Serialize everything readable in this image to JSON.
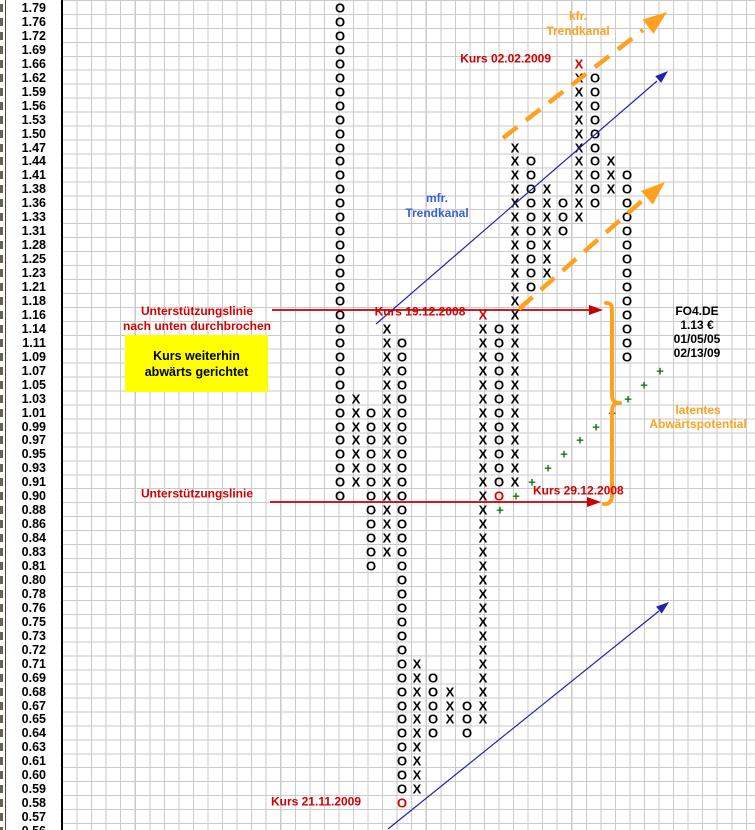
{
  "colors": {
    "red_text": "#D40000",
    "red_line": "#C80000",
    "orange": "#FFA11E",
    "blue_text": "#3761D6",
    "blue_line": "#2222AC",
    "green": "#157815",
    "yellow": "#FFFF00",
    "grid": "#CACACA",
    "symbol": "#000000"
  },
  "annotations": {
    "kfr_trendkanal": {
      "line1": "kfr.",
      "line2": "Trendkanal"
    },
    "mfr_trendkanal": {
      "line1": "mfr.",
      "line2": "Trendkanal"
    },
    "kurs_02_02_2009": "Kurs 02.02.2009",
    "kurs_19_12_2008": "Kurs 19.12.2008",
    "kurs_29_12_2008": "Kurs 29.12.2008",
    "kurs_21_11_2009": "Kurs 21.11.2009",
    "support_broken": {
      "line1": "Unterstützungslinie",
      "line2": "nach unten durchbrochen"
    },
    "support": "Unterstützungslinie",
    "note_box": {
      "line1": "Kurs weiterhin",
      "line2": "abwärts gerichtet"
    },
    "latent": {
      "line1": "latentes",
      "line2": "Abwärtspotential"
    }
  },
  "chart_data": {
    "type": "point-and-figure",
    "instrument": {
      "symbol": "FO4.DE",
      "last_price": "1.13 €",
      "start_date": "01/05/05",
      "end_date": "02/13/09"
    },
    "y_axis_prices": [
      "1.79",
      "1.76",
      "1.72",
      "1.69",
      "1.66",
      "1.62",
      "1.59",
      "1.56",
      "1.53",
      "1.50",
      "1.47",
      "1.44",
      "1.41",
      "1.38",
      "1.36",
      "1.33",
      "1.31",
      "1.28",
      "1.25",
      "1.23",
      "1.21",
      "1.18",
      "1.16",
      "1.14",
      "1.11",
      "1.09",
      "1.07",
      "1.05",
      "1.03",
      "1.01",
      "0.99",
      "0.97",
      "0.95",
      "0.93",
      "0.91",
      "0.90",
      "0.88",
      "0.86",
      "0.84",
      "0.83",
      "0.81",
      "0.80",
      "0.78",
      "0.76",
      "0.75",
      "0.73",
      "0.72",
      "0.71",
      "0.69",
      "0.68",
      "0.67",
      "0.65",
      "0.64",
      "0.63",
      "0.61",
      "0.60",
      "0.59",
      "0.58",
      "0.57",
      "0.56"
    ],
    "grid_on": true,
    "columns": [
      {
        "symbol": "O",
        "x": 340,
        "top_price": "1.79",
        "bottom_price": "0.90",
        "top_row": 0,
        "bottom_row": 35,
        "red_rows": []
      },
      {
        "symbol": "X",
        "x": 356,
        "top_price": "1.03",
        "bottom_price": "0.91",
        "top_row": 28,
        "bottom_row": 34,
        "red_rows": []
      },
      {
        "symbol": "O",
        "x": 371,
        "top_price": "1.01",
        "bottom_price": "0.81",
        "top_row": 29,
        "bottom_row": 40,
        "red_rows": []
      },
      {
        "symbol": "X",
        "x": 387,
        "top_price": "1.14",
        "bottom_price": "0.83",
        "top_row": 23,
        "bottom_row": 39,
        "red_rows": []
      },
      {
        "symbol": "O",
        "x": 402,
        "top_price": "1.11",
        "bottom_price": "0.58",
        "top_row": 24,
        "bottom_row": 57,
        "red_rows": [
          57
        ]
      },
      {
        "symbol": "X",
        "x": 417,
        "top_price": "0.71",
        "bottom_price": "0.59",
        "top_row": 47,
        "bottom_row": 56,
        "red_rows": []
      },
      {
        "symbol": "O",
        "x": 433,
        "top_price": "0.69",
        "bottom_price": "0.64",
        "top_row": 48,
        "bottom_row": 52,
        "red_rows": []
      },
      {
        "symbol": "X",
        "x": 450,
        "top_price": "0.68",
        "bottom_price": "0.65",
        "top_row": 49,
        "bottom_row": 51,
        "red_rows": []
      },
      {
        "symbol": "O",
        "x": 467,
        "top_price": "0.67",
        "bottom_price": "0.64",
        "top_row": 50,
        "bottom_row": 52,
        "red_rows": []
      },
      {
        "symbol": "X",
        "x": 483,
        "top_price": "1.16",
        "bottom_price": "0.65",
        "top_row": 22,
        "bottom_row": 51,
        "red_rows": [
          22
        ]
      },
      {
        "symbol": "O",
        "x": 499,
        "top_price": "1.14",
        "bottom_price": "0.90",
        "top_row": 23,
        "bottom_row": 35,
        "red_rows": [
          35
        ]
      },
      {
        "symbol": "X",
        "x": 515,
        "top_price": "1.47",
        "bottom_price": "0.91",
        "top_row": 10,
        "bottom_row": 34,
        "red_rows": []
      },
      {
        "symbol": "O",
        "x": 531,
        "top_price": "1.44",
        "bottom_price": "1.21",
        "top_row": 11,
        "bottom_row": 20,
        "red_rows": []
      },
      {
        "symbol": "X",
        "x": 547,
        "top_price": "1.38",
        "bottom_price": "1.23",
        "top_row": 13,
        "bottom_row": 19,
        "red_rows": []
      },
      {
        "symbol": "O",
        "x": 563,
        "top_price": "1.36",
        "bottom_price": "1.31",
        "top_row": 14,
        "bottom_row": 16,
        "red_rows": []
      },
      {
        "symbol": "X",
        "x": 579,
        "top_price": "1.66",
        "bottom_price": "1.33",
        "top_row": 4,
        "bottom_row": 15,
        "red_rows": [
          4
        ]
      },
      {
        "symbol": "O",
        "x": 595,
        "top_price": "1.62",
        "bottom_price": "1.36",
        "top_row": 5,
        "bottom_row": 14,
        "red_rows": []
      },
      {
        "symbol": "X",
        "x": 611,
        "top_price": "1.44",
        "bottom_price": "1.38",
        "top_row": 11,
        "bottom_row": 13,
        "red_rows": []
      },
      {
        "symbol": "O",
        "x": 627,
        "top_price": "1.41",
        "bottom_price": "1.09",
        "top_row": 12,
        "bottom_row": 25,
        "red_rows": []
      }
    ],
    "plus_markers": [
      {
        "x": 500,
        "row": 36,
        "price": "0.88"
      },
      {
        "x": 516,
        "row": 35,
        "price": "0.90"
      },
      {
        "x": 532,
        "row": 34,
        "price": "0.91"
      },
      {
        "x": 548,
        "row": 33,
        "price": "0.93"
      },
      {
        "x": 564,
        "row": 32,
        "price": "0.95"
      },
      {
        "x": 580,
        "row": 31,
        "price": "0.97"
      },
      {
        "x": 596,
        "row": 30,
        "price": "0.99"
      },
      {
        "x": 612,
        "row": 29,
        "price": "1.01"
      },
      {
        "x": 628,
        "row": 28,
        "price": "1.03"
      },
      {
        "x": 644,
        "row": 27,
        "price": "1.05"
      },
      {
        "x": 660,
        "row": 26,
        "price": "1.07"
      }
    ],
    "support_lines": [
      {
        "price": "1.16",
        "y": 310,
        "x1": 272,
        "x2": 590,
        "tip_x": 603
      },
      {
        "price": "0.90",
        "y": 502,
        "x1": 270,
        "x2": 588,
        "tip_x": 601
      }
    ],
    "blue_trend_lines": [
      {
        "x1": 376,
        "y1": 324,
        "x2": 657,
        "y2": 81,
        "tip": [
          668,
          71
        ]
      },
      {
        "x1": 388,
        "y1": 829,
        "x2": 659,
        "y2": 611,
        "tip": [
          669,
          602
        ]
      }
    ],
    "orange_trend_lines": [
      {
        "x1": 503,
        "y1": 138,
        "x2": 643,
        "y2": 30,
        "tip": [
          667,
          12
        ]
      },
      {
        "x1": 519,
        "y1": 309,
        "x2": 643,
        "y2": 200,
        "tip": [
          665,
          182
        ]
      }
    ],
    "brace": {
      "x": 612,
      "top_y": 303,
      "bottom_y": 504,
      "tip_x": 620,
      "mid_y": 403
    }
  }
}
